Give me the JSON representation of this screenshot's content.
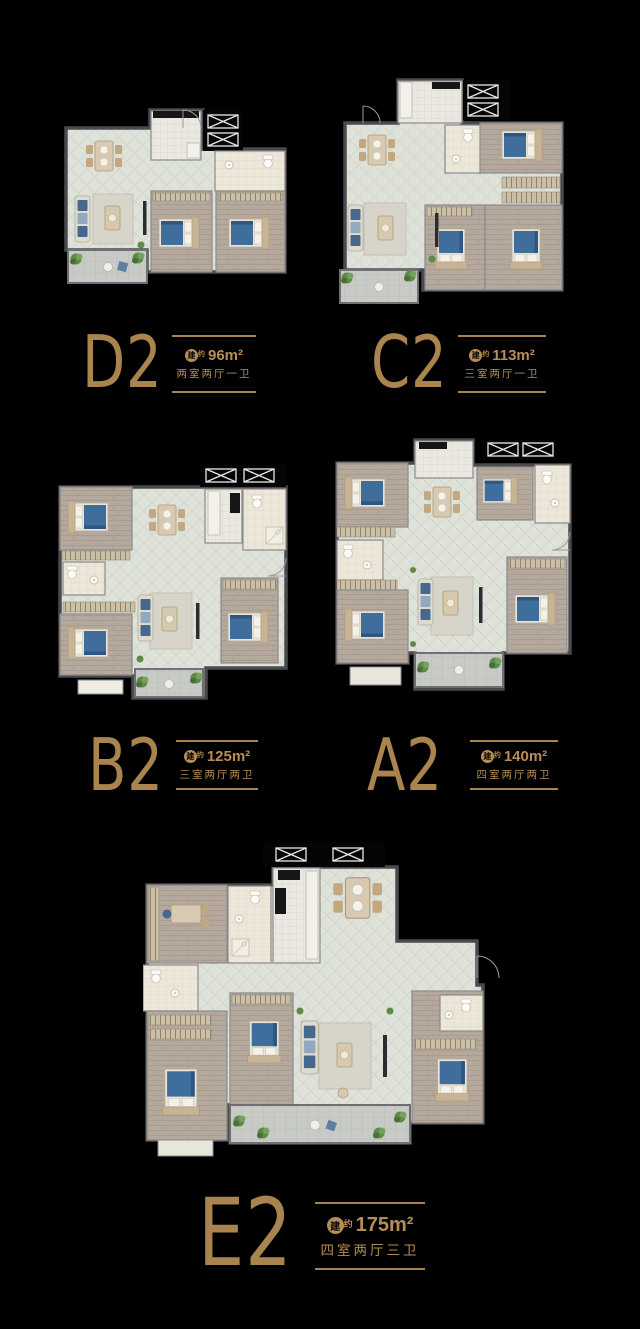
{
  "poster": {
    "background": "#000000",
    "gold": "#ab8450"
  },
  "area_icon": {
    "circle_glyph": "建",
    "sup_glyph": "约"
  },
  "units": [
    {
      "code": "D2",
      "area": "96m²",
      "rooms": "两室两厅一卫"
    },
    {
      "code": "C2",
      "area": "113m²",
      "rooms": "三室两厅一卫"
    },
    {
      "code": "B2",
      "area": "125m²",
      "rooms": "三室两厅两卫"
    },
    {
      "code": "A2",
      "area": "140m²",
      "rooms": "四室两厅两卫"
    },
    {
      "code": "E2",
      "area": "175m²",
      "rooms": "四室两厅三卫"
    }
  ]
}
